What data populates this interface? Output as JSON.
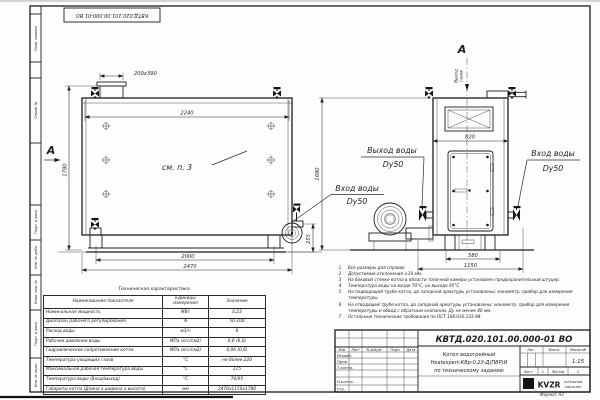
{
  "stamp": {
    "doc_number_top": "КВТД.020.101.00.000-01 ВО"
  },
  "margin": {
    "labels": [
      "Перв. примен.",
      "Справ. №",
      "Подп. и дата",
      "Инв. № дубл.",
      "Взам. инв. №",
      "Подп. и дата",
      "Инв. № подл."
    ]
  },
  "side_view": {
    "section_label": "А",
    "dim_chimney": "200х390",
    "dim_width": "2240",
    "dim_height": "1780",
    "dim_base": "2000",
    "dim_total": "2470",
    "dim_base_height": "255",
    "callout": "см. п. 3",
    "inlet_label_1": "Вход воды",
    "inlet_label_2": "Dy50"
  },
  "front_view": {
    "view_label": "А",
    "gas_label_1": "Выход",
    "gas_label_2": "газов",
    "dim_width": "820",
    "dim_base": "580",
    "dim_total": "1150",
    "dim_height": "1690",
    "outlet_label_1": "Выход воды",
    "outlet_label_2": "Dy50",
    "inlet_label_1": "Вход воды",
    "inlet_label_2": "Dy50"
  },
  "tech_table": {
    "title": "Техническая характеристика",
    "col_name": "Наименование показателя",
    "col_units_1": "Единицы",
    "col_units_2": "измерения",
    "col_value": "Значение",
    "rows": [
      {
        "name": "Номинальная мощность",
        "units": "МВт",
        "value": "0,23"
      },
      {
        "name": "Диапазон рабочего регулирования",
        "units": "%",
        "value": "50-100"
      },
      {
        "name": "Расход воды",
        "units": "м3/ч",
        "value": "8"
      },
      {
        "name": "Рабочее давление воды",
        "units": "МПа (кгс/см2)",
        "value": "0,6 (6,0)"
      },
      {
        "name": "Гидравлическое сопротивление котла",
        "units": "МПа (кгс/см2)",
        "value": "0,06 (0,6)"
      },
      {
        "name": "Температура уходящих газов",
        "units": "°С",
        "value": "не более 220"
      },
      {
        "name": "Максимальная рабочая температура воды",
        "units": "°С",
        "value": "115"
      },
      {
        "name": "Температура воды (Вход/выход)",
        "units": "°С",
        "value": "70/95"
      },
      {
        "name": "Габариты котла (Длина х ширина х высота)",
        "units": "мм",
        "value": "2470х1150х1780"
      }
    ]
  },
  "notes": {
    "items": [
      {
        "n": "1",
        "text": "Все размеры для справок"
      },
      {
        "n": "2",
        "text": "Допустимые отклонения ±10 мм."
      },
      {
        "n": "3",
        "text": "На боковой стенке котла в области топочной камеры установлен предохранительный штуцер."
      },
      {
        "n": "4",
        "text": "Температура воды на входе 70°С, на выходе 95°С."
      },
      {
        "n": "5",
        "text": "На подводящей трубе котла, до запорной арматуры установлены: манометр, прибор для измерения температуры."
      },
      {
        "n": "6",
        "text": "На отводящей трубе котла, до запорной арматуры установлены: манометр, прибор для измерения температуры и обвод с обратным клапаном. Ду не менее 40 мм."
      },
      {
        "n": "7",
        "text": "Остальные технические требования по ОСТ 108.030.133-84."
      }
    ]
  },
  "title_block": {
    "doc_number": "КВТД.020.101.00.000-01 ВО",
    "name_line1": "Котел водогрейный",
    "name_line2": "Heatexpert-КВр-0,23-Д(ПВР)И",
    "name_line3": "по техническому заданию",
    "header_izm": "Изм",
    "header_list": "Лист",
    "header_ndoc": "N докум.",
    "header_podp": "Подп.",
    "header_data": "Дата",
    "row_razrab": "Разраб.",
    "row_prov": "Пров.",
    "row_tkontr": "Т.контр.",
    "row_nkontr": "Н.контр.",
    "row_utv": "Утв.",
    "lit": "Лит.",
    "massa": "Масса",
    "masshtab": "Масштаб",
    "scale": "1:15",
    "sheet_label": "Лист",
    "sheet_value": "1",
    "sheets_label": "Листов",
    "sheets_value": "2",
    "logo_text": "KVZR",
    "logo_caption_1": "КОТЕЛЬНЫЙ",
    "logo_caption_2": "ЗАВОД РЭП",
    "format_label": "Формат А3"
  }
}
